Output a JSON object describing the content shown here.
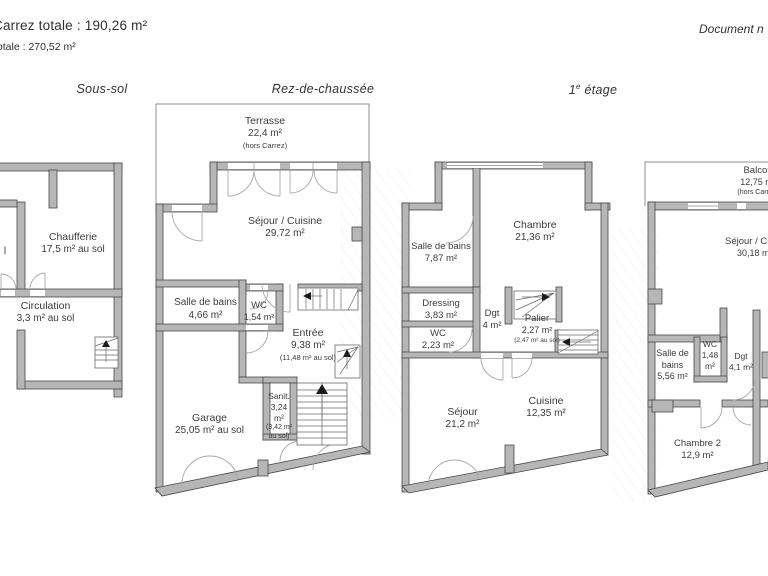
{
  "header": {
    "surface_line1": "Carrez totale :  190,26 m²",
    "surface_line2": "totale :  270,52 m²",
    "doc_note": "Document n"
  },
  "colors": {
    "wall_fill": "#b6b6b6",
    "wall_stroke": "#4a4a4a",
    "thin_outline": "#8f8f8f",
    "text": "#3c3c3c"
  },
  "floors": {
    "sous_sol": {
      "title": "Sous-sol",
      "rooms": {
        "hidden_fragment": "l",
        "chaufferie": {
          "name": "Chaufferie",
          "area": "17,5 m² au sol"
        },
        "circulation": {
          "name": "Circulation",
          "area": "3,3 m²  au sol"
        }
      }
    },
    "rdc": {
      "title": "Rez-de-chaussée",
      "rooms": {
        "terrasse": {
          "name": "Terrasse",
          "area": "22,4 m²",
          "note": "(hors Carrez)"
        },
        "sejour_cuisine": {
          "name": "Séjour / Cuisine",
          "area": "29,72 m²"
        },
        "salle_de_bains": {
          "name": "Salle de bains",
          "area": "4,66 m²"
        },
        "wc": {
          "name": "WC",
          "area": "1,54 m²"
        },
        "entree": {
          "name": "Entrée",
          "area": "9,38 m²",
          "note": "(11,48 m² au sol)"
        },
        "sanitaire": {
          "l1": "Sanit.",
          "l2": "3,24",
          "l3": "m²",
          "l4": "(3,42 m²",
          "l5": "au sol)"
        },
        "garage": {
          "name": "Garage",
          "area": "25,05 m² au sol"
        }
      }
    },
    "etage1": {
      "title_num": "1",
      "title_sup": "e",
      "title_rest": "étage",
      "rooms": {
        "chambre": {
          "name": "Chambre",
          "area": "21,36 m²"
        },
        "salle_de_bains": {
          "name": "Salle de bains",
          "area": "7,87 m²"
        },
        "dressing": {
          "name": "Dressing",
          "area": "3,83 m²"
        },
        "wc": {
          "name": "WC",
          "area": "2,23 m²"
        },
        "dgt": {
          "name": "Dgt",
          "area": "4 m²"
        },
        "palier": {
          "name": "Palier",
          "area": "2,27 m²",
          "note": "(2,47 m² au sol)"
        },
        "sejour": {
          "name": "Séjour",
          "area": "21,2 m²"
        },
        "cuisine": {
          "name": "Cuisine",
          "area": "12,35 m²"
        }
      }
    },
    "etage2": {
      "rooms": {
        "balcon": {
          "name": "Balcon",
          "area": "12,75 m²",
          "note": "(hors Carrez)"
        },
        "sejour_cuisine": {
          "name": "Séjour / Cu",
          "area": "30,18 m"
        },
        "salle_de_bains": {
          "l1": "Salle de",
          "l2": "bains",
          "l3": "5,56 m²"
        },
        "wc": {
          "l1": "WC",
          "l2": "1,48",
          "l3": "m²"
        },
        "dgt": {
          "name": "Dgt",
          "area": "4,1 m²"
        },
        "chambre2": {
          "name": "Chambre 2",
          "area": "12,9 m²"
        }
      }
    }
  }
}
